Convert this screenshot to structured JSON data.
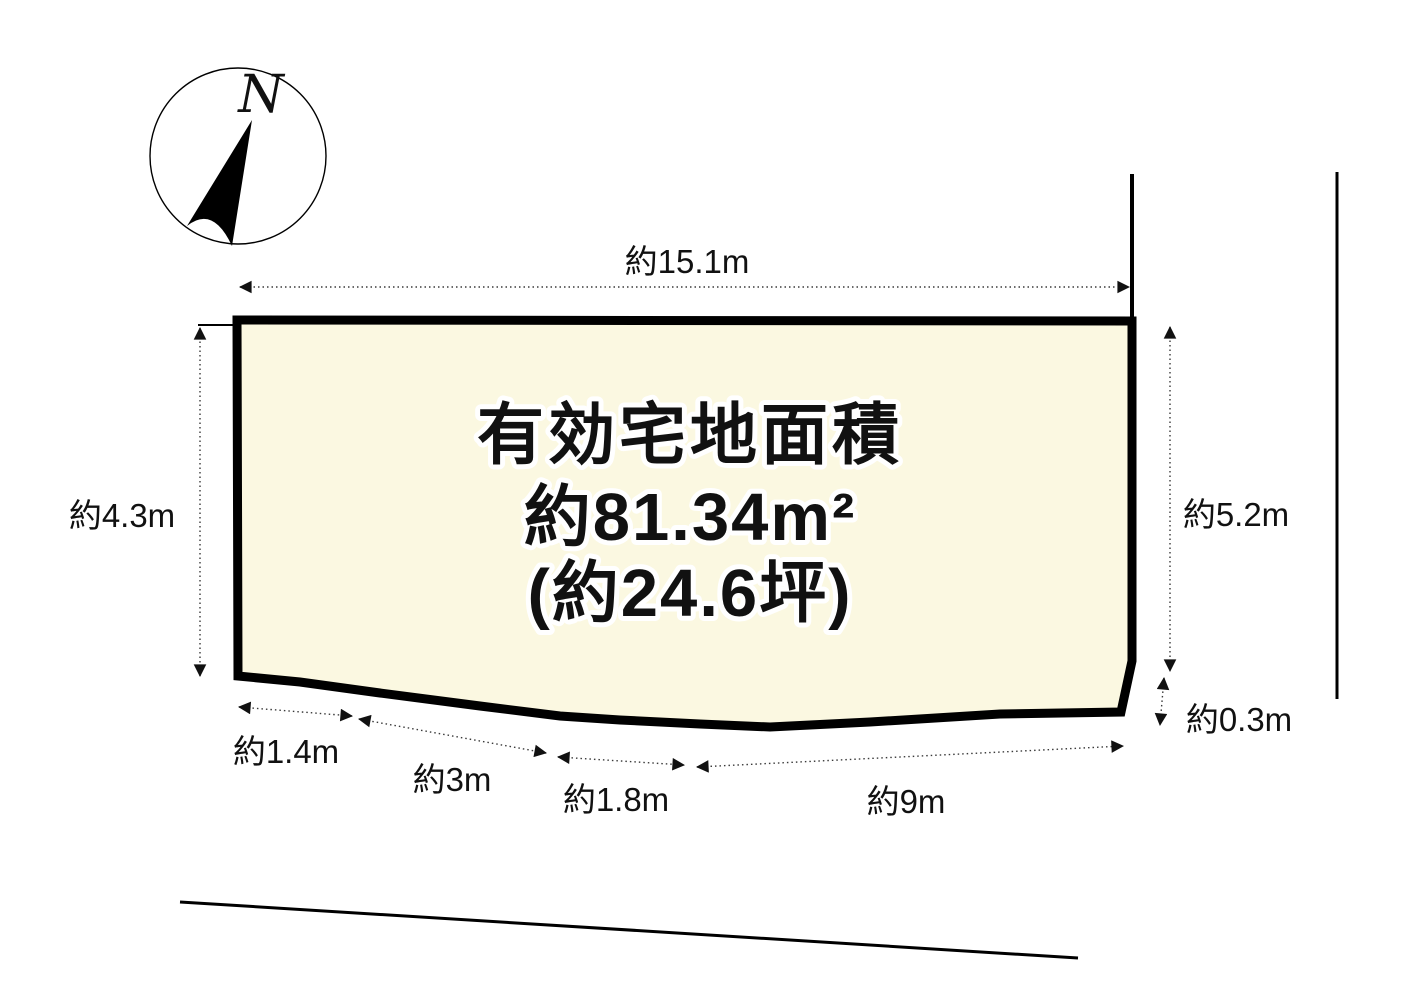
{
  "compass": {
    "north_label": "N"
  },
  "parcel": {
    "area_title": "有効宅地面積",
    "area_value": "約81.34m²",
    "area_tsubo": "(約24.6坪)",
    "fill_color": "#FBF8E1",
    "outline_color": "#000000"
  },
  "dimensions": {
    "top": {
      "label": "約15.1m"
    },
    "left": {
      "label": "約4.3m"
    },
    "right": {
      "label": "約5.2m"
    },
    "right_offset": {
      "label": "約0.3m"
    },
    "bottom_seg_1": {
      "label": "約1.4m"
    },
    "bottom_seg_2": {
      "label": "約3m"
    },
    "bottom_seg_3": {
      "label": "約1.8m"
    },
    "bottom_seg_4": {
      "label": "約9m"
    }
  }
}
